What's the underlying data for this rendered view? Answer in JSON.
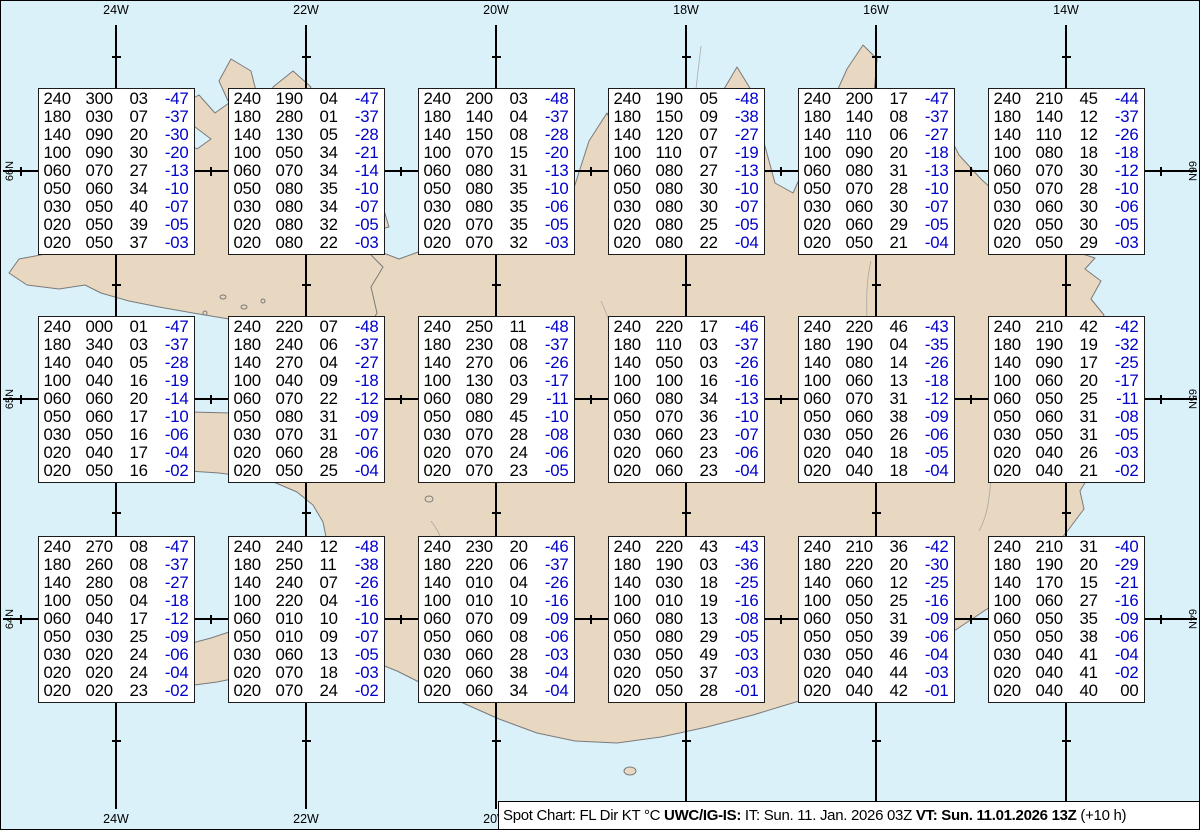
{
  "legend": {
    "part1": "Spot Chart: FL Dir KT °C ",
    "source_bold": "UWC/IG-IS:",
    "part2": " IT: Sun. 11. Jan. 2026 03Z ",
    "vt_bold": "VT: Sun. 11.01.2026 13Z",
    "part3": " (+10 h)"
  },
  "colors": {
    "ocean": "#daf1f9",
    "land": "#e8d8c2",
    "coast": "#7a7a7a",
    "grid": "#000000",
    "data_text": "#000000",
    "temp_negative": "#0000cc",
    "box_background": "#ffffff"
  },
  "map": {
    "lon_gridlines": [
      {
        "label": "24W",
        "x": 115
      },
      {
        "label": "22W",
        "x": 305
      },
      {
        "label": "20W",
        "x": 495
      },
      {
        "label": "18W",
        "x": 685
      },
      {
        "label": "16W",
        "x": 875
      },
      {
        "label": "14W",
        "x": 1065
      }
    ],
    "lat_gridlines": [
      {
        "label": "66N",
        "y": 170
      },
      {
        "label": "65N",
        "y": 398
      },
      {
        "label": "64N",
        "y": 618
      }
    ],
    "lat_tick_xs": [
      20,
      210,
      400,
      590,
      780,
      970,
      1160
    ],
    "lon_tick_ys": [
      56,
      284,
      512,
      740
    ]
  },
  "column_headers": [
    "FL",
    "Dir",
    "KT",
    "°C"
  ],
  "stations": [
    {
      "lat": "66N",
      "lon": "24W",
      "rows": [
        [
          "240",
          "300",
          "03",
          "-47"
        ],
        [
          "180",
          "030",
          "07",
          "-37"
        ],
        [
          "140",
          "090",
          "20",
          "-30"
        ],
        [
          "100",
          "090",
          "30",
          "-20"
        ],
        [
          "060",
          "070",
          "27",
          "-13"
        ],
        [
          "050",
          "060",
          "34",
          "-10"
        ],
        [
          "030",
          "050",
          "40",
          "-07"
        ],
        [
          "020",
          "050",
          "39",
          "-05"
        ],
        [
          "020",
          "050",
          "37",
          "-03"
        ]
      ]
    },
    {
      "lat": "66N",
      "lon": "22W",
      "rows": [
        [
          "240",
          "190",
          "04",
          "-47"
        ],
        [
          "180",
          "280",
          "01",
          "-37"
        ],
        [
          "140",
          "130",
          "05",
          "-28"
        ],
        [
          "100",
          "050",
          "34",
          "-21"
        ],
        [
          "060",
          "070",
          "34",
          "-14"
        ],
        [
          "050",
          "080",
          "35",
          "-10"
        ],
        [
          "030",
          "080",
          "34",
          "-07"
        ],
        [
          "020",
          "080",
          "32",
          "-05"
        ],
        [
          "020",
          "080",
          "22",
          "-03"
        ]
      ]
    },
    {
      "lat": "66N",
      "lon": "20W",
      "rows": [
        [
          "240",
          "200",
          "03",
          "-48"
        ],
        [
          "180",
          "140",
          "04",
          "-37"
        ],
        [
          "140",
          "150",
          "08",
          "-28"
        ],
        [
          "100",
          "070",
          "15",
          "-20"
        ],
        [
          "060",
          "080",
          "31",
          "-13"
        ],
        [
          "050",
          "080",
          "35",
          "-10"
        ],
        [
          "030",
          "080",
          "35",
          "-06"
        ],
        [
          "020",
          "070",
          "35",
          "-05"
        ],
        [
          "020",
          "070",
          "32",
          "-03"
        ]
      ]
    },
    {
      "lat": "66N",
      "lon": "18W",
      "rows": [
        [
          "240",
          "190",
          "05",
          "-48"
        ],
        [
          "180",
          "150",
          "09",
          "-38"
        ],
        [
          "140",
          "120",
          "07",
          "-27"
        ],
        [
          "100",
          "110",
          "07",
          "-19"
        ],
        [
          "060",
          "080",
          "27",
          "-13"
        ],
        [
          "050",
          "080",
          "30",
          "-10"
        ],
        [
          "030",
          "080",
          "30",
          "-07"
        ],
        [
          "020",
          "080",
          "25",
          "-05"
        ],
        [
          "020",
          "080",
          "22",
          "-04"
        ]
      ]
    },
    {
      "lat": "66N",
      "lon": "16W",
      "rows": [
        [
          "240",
          "200",
          "17",
          "-47"
        ],
        [
          "180",
          "140",
          "08",
          "-37"
        ],
        [
          "140",
          "110",
          "06",
          "-27"
        ],
        [
          "100",
          "090",
          "20",
          "-18"
        ],
        [
          "060",
          "080",
          "31",
          "-13"
        ],
        [
          "050",
          "070",
          "28",
          "-10"
        ],
        [
          "030",
          "060",
          "30",
          "-07"
        ],
        [
          "020",
          "060",
          "29",
          "-05"
        ],
        [
          "020",
          "050",
          "21",
          "-04"
        ]
      ]
    },
    {
      "lat": "66N",
      "lon": "14W",
      "rows": [
        [
          "240",
          "210",
          "45",
          "-44"
        ],
        [
          "180",
          "140",
          "12",
          "-37"
        ],
        [
          "140",
          "110",
          "12",
          "-26"
        ],
        [
          "100",
          "080",
          "18",
          "-18"
        ],
        [
          "060",
          "070",
          "30",
          "-12"
        ],
        [
          "050",
          "070",
          "28",
          "-10"
        ],
        [
          "030",
          "060",
          "30",
          "-06"
        ],
        [
          "020",
          "050",
          "30",
          "-05"
        ],
        [
          "020",
          "050",
          "29",
          "-03"
        ]
      ]
    },
    {
      "lat": "65N",
      "lon": "24W",
      "rows": [
        [
          "240",
          "000",
          "01",
          "-47"
        ],
        [
          "180",
          "340",
          "03",
          "-37"
        ],
        [
          "140",
          "040",
          "05",
          "-28"
        ],
        [
          "100",
          "040",
          "16",
          "-19"
        ],
        [
          "060",
          "060",
          "20",
          "-14"
        ],
        [
          "050",
          "060",
          "17",
          "-10"
        ],
        [
          "030",
          "050",
          "16",
          "-06"
        ],
        [
          "020",
          "040",
          "17",
          "-04"
        ],
        [
          "020",
          "050",
          "16",
          "-02"
        ]
      ]
    },
    {
      "lat": "65N",
      "lon": "22W",
      "rows": [
        [
          "240",
          "220",
          "07",
          "-48"
        ],
        [
          "180",
          "240",
          "06",
          "-37"
        ],
        [
          "140",
          "270",
          "04",
          "-27"
        ],
        [
          "100",
          "040",
          "09",
          "-18"
        ],
        [
          "060",
          "070",
          "22",
          "-12"
        ],
        [
          "050",
          "080",
          "31",
          "-09"
        ],
        [
          "030",
          "070",
          "31",
          "-07"
        ],
        [
          "020",
          "060",
          "28",
          "-06"
        ],
        [
          "020",
          "050",
          "25",
          "-04"
        ]
      ]
    },
    {
      "lat": "65N",
      "lon": "20W",
      "rows": [
        [
          "240",
          "250",
          "11",
          "-48"
        ],
        [
          "180",
          "230",
          "08",
          "-37"
        ],
        [
          "140",
          "270",
          "06",
          "-26"
        ],
        [
          "100",
          "130",
          "03",
          "-17"
        ],
        [
          "060",
          "080",
          "29",
          "-11"
        ],
        [
          "050",
          "080",
          "45",
          "-10"
        ],
        [
          "030",
          "070",
          "28",
          "-08"
        ],
        [
          "020",
          "070",
          "24",
          "-06"
        ],
        [
          "020",
          "070",
          "23",
          "-05"
        ]
      ]
    },
    {
      "lat": "65N",
      "lon": "18W",
      "rows": [
        [
          "240",
          "220",
          "17",
          "-46"
        ],
        [
          "180",
          "110",
          "03",
          "-37"
        ],
        [
          "140",
          "050",
          "03",
          "-26"
        ],
        [
          "100",
          "100",
          "16",
          "-16"
        ],
        [
          "060",
          "080",
          "34",
          "-13"
        ],
        [
          "050",
          "070",
          "36",
          "-10"
        ],
        [
          "030",
          "060",
          "23",
          "-07"
        ],
        [
          "020",
          "060",
          "23",
          "-06"
        ],
        [
          "020",
          "060",
          "23",
          "-04"
        ]
      ]
    },
    {
      "lat": "65N",
      "lon": "16W",
      "rows": [
        [
          "240",
          "220",
          "46",
          "-43"
        ],
        [
          "180",
          "190",
          "04",
          "-35"
        ],
        [
          "140",
          "080",
          "14",
          "-26"
        ],
        [
          "100",
          "060",
          "13",
          "-18"
        ],
        [
          "060",
          "070",
          "31",
          "-12"
        ],
        [
          "050",
          "060",
          "38",
          "-09"
        ],
        [
          "030",
          "050",
          "26",
          "-06"
        ],
        [
          "020",
          "040",
          "18",
          "-05"
        ],
        [
          "020",
          "040",
          "18",
          "-04"
        ]
      ]
    },
    {
      "lat": "65N",
      "lon": "14W",
      "rows": [
        [
          "240",
          "210",
          "42",
          "-42"
        ],
        [
          "180",
          "190",
          "19",
          "-32"
        ],
        [
          "140",
          "090",
          "17",
          "-25"
        ],
        [
          "100",
          "060",
          "20",
          "-17"
        ],
        [
          "060",
          "050",
          "25",
          "-11"
        ],
        [
          "050",
          "060",
          "31",
          "-08"
        ],
        [
          "030",
          "050",
          "31",
          "-05"
        ],
        [
          "020",
          "040",
          "26",
          "-03"
        ],
        [
          "020",
          "040",
          "21",
          "-02"
        ]
      ]
    },
    {
      "lat": "64N",
      "lon": "24W",
      "rows": [
        [
          "240",
          "270",
          "08",
          "-47"
        ],
        [
          "180",
          "260",
          "08",
          "-37"
        ],
        [
          "140",
          "280",
          "08",
          "-27"
        ],
        [
          "100",
          "050",
          "04",
          "-18"
        ],
        [
          "060",
          "040",
          "17",
          "-12"
        ],
        [
          "050",
          "030",
          "25",
          "-09"
        ],
        [
          "030",
          "020",
          "24",
          "-06"
        ],
        [
          "020",
          "020",
          "24",
          "-04"
        ],
        [
          "020",
          "020",
          "23",
          "-02"
        ]
      ]
    },
    {
      "lat": "64N",
      "lon": "22W",
      "rows": [
        [
          "240",
          "240",
          "12",
          "-48"
        ],
        [
          "180",
          "250",
          "11",
          "-38"
        ],
        [
          "140",
          "240",
          "07",
          "-26"
        ],
        [
          "100",
          "220",
          "04",
          "-16"
        ],
        [
          "060",
          "010",
          "10",
          "-10"
        ],
        [
          "050",
          "010",
          "09",
          "-07"
        ],
        [
          "030",
          "060",
          "13",
          "-05"
        ],
        [
          "020",
          "070",
          "18",
          "-03"
        ],
        [
          "020",
          "070",
          "24",
          "-02"
        ]
      ]
    },
    {
      "lat": "64N",
      "lon": "20W",
      "rows": [
        [
          "240",
          "230",
          "20",
          "-46"
        ],
        [
          "180",
          "220",
          "06",
          "-37"
        ],
        [
          "140",
          "010",
          "04",
          "-26"
        ],
        [
          "100",
          "010",
          "10",
          "-16"
        ],
        [
          "060",
          "070",
          "09",
          "-09"
        ],
        [
          "050",
          "060",
          "08",
          "-06"
        ],
        [
          "030",
          "060",
          "28",
          "-03"
        ],
        [
          "020",
          "060",
          "38",
          "-04"
        ],
        [
          "020",
          "060",
          "34",
          "-04"
        ]
      ]
    },
    {
      "lat": "64N",
      "lon": "18W",
      "rows": [
        [
          "240",
          "220",
          "43",
          "-43"
        ],
        [
          "180",
          "190",
          "03",
          "-36"
        ],
        [
          "140",
          "030",
          "18",
          "-25"
        ],
        [
          "100",
          "010",
          "19",
          "-16"
        ],
        [
          "060",
          "080",
          "13",
          "-08"
        ],
        [
          "050",
          "080",
          "29",
          "-05"
        ],
        [
          "030",
          "050",
          "49",
          "-03"
        ],
        [
          "020",
          "050",
          "37",
          "-03"
        ],
        [
          "020",
          "050",
          "28",
          "-01"
        ]
      ]
    },
    {
      "lat": "64N",
      "lon": "16W",
      "rows": [
        [
          "240",
          "210",
          "36",
          "-42"
        ],
        [
          "180",
          "220",
          "20",
          "-30"
        ],
        [
          "140",
          "060",
          "12",
          "-25"
        ],
        [
          "100",
          "050",
          "25",
          "-16"
        ],
        [
          "060",
          "050",
          "31",
          "-09"
        ],
        [
          "050",
          "050",
          "39",
          "-06"
        ],
        [
          "030",
          "050",
          "46",
          "-04"
        ],
        [
          "020",
          "040",
          "44",
          "-03"
        ],
        [
          "020",
          "040",
          "42",
          "-01"
        ]
      ]
    },
    {
      "lat": "64N",
      "lon": "14W",
      "rows": [
        [
          "240",
          "210",
          "31",
          "-40"
        ],
        [
          "180",
          "190",
          "20",
          "-29"
        ],
        [
          "140",
          "170",
          "15",
          "-21"
        ],
        [
          "100",
          "060",
          "27",
          "-16"
        ],
        [
          "060",
          "050",
          "35",
          "-09"
        ],
        [
          "050",
          "050",
          "38",
          "-06"
        ],
        [
          "030",
          "040",
          "41",
          "-04"
        ],
        [
          "020",
          "040",
          "41",
          "-02"
        ],
        [
          "020",
          "040",
          "40",
          "00"
        ]
      ]
    }
  ]
}
